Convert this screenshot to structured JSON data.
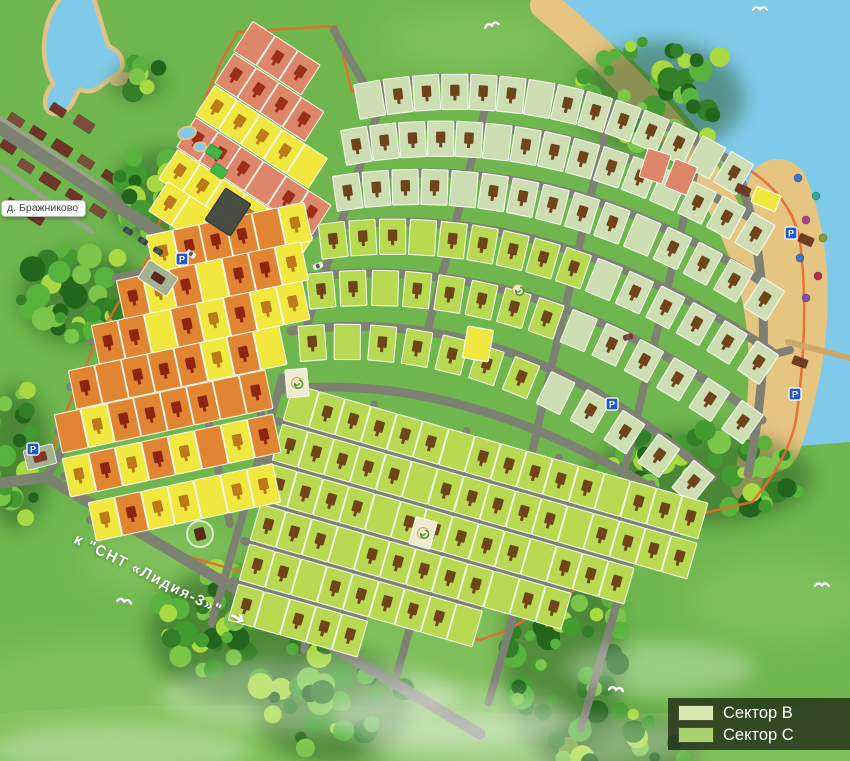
{
  "map": {
    "labels": {
      "village": "д. Бражниково",
      "road_to": "к \"СНТ «Лидия-3»\"",
      "road_to_arrow": "➔"
    },
    "legend": {
      "items": [
        {
          "id": "sector-b",
          "label": "Сектор B",
          "color": "#d9e6ae"
        },
        {
          "id": "sector-c",
          "label": "Сектор C",
          "color": "#a9d26e"
        }
      ]
    },
    "markers": {
      "parking": "P"
    },
    "palette": {
      "grass": "#6db54b",
      "grass_light": "#a7d87a",
      "water": "#7ec9e9",
      "water_deep": "#66b9e0",
      "sand": "#e6c47f",
      "road": "#7b7f70",
      "road_minor": "#98a089",
      "boundary": "#e4672e",
      "sector_b_plot": "#cdddb2",
      "sector_c_plot": "#b7d84f",
      "free_plot": "#f1e73c",
      "reserved_plot": "#dd8467",
      "sold_plot": "#e0832f",
      "utility_plot": "#a3b18f",
      "marker_on_green": "#6f4015",
      "marker_on_yellow": "#bf7716",
      "marker_on_salmon": "#9c2a12",
      "marker_on_orange": "#8f200d",
      "village_house": "#6e3126",
      "legend_bg": "rgba(30,40,20,0.78)",
      "parking_blue": "#1d56c8"
    },
    "beach": {
      "umbrella_dots": [
        "#3a6fc4",
        "#2ea89a",
        "#b03a8c",
        "#8a9a2e",
        "#3a6fc4",
        "#b02a4a",
        "#7a4ab0"
      ]
    }
  }
}
